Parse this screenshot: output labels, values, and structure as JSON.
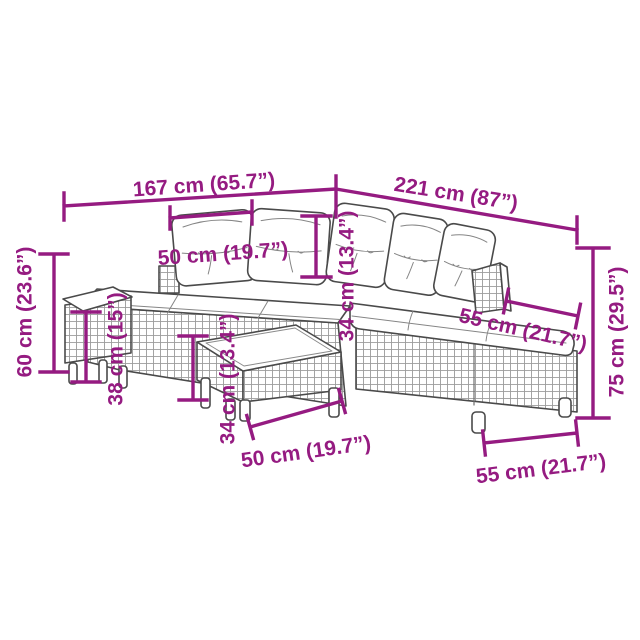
{
  "diagram": {
    "illustration": "l-shaped-rattan-garden-sofa-set-with-footstool-and-coffee-table-line-art",
    "colors": {
      "accent": "#951B81",
      "line_art": "#4a4a4a",
      "rattan_grid": "#9b9b9b",
      "background": "#ffffff"
    },
    "dims": {
      "overall_width_left": "167 cm (65.7”)",
      "overall_width_right": "221 cm (87”)",
      "back_cushion_width": "50 cm (19.7”)",
      "back_cushion_height": "34 cm (13.4”)",
      "height_left": "60 cm (23.6”)",
      "footstool_height": "38 cm (15”)",
      "table_height": "34 cm (13.4”)",
      "table_width": "50 cm (19.7”)",
      "seat_depth": "55 cm (21.7”)",
      "height_right": "75 cm (29.5”)",
      "module_width": "55 cm (21.7”)"
    }
  }
}
